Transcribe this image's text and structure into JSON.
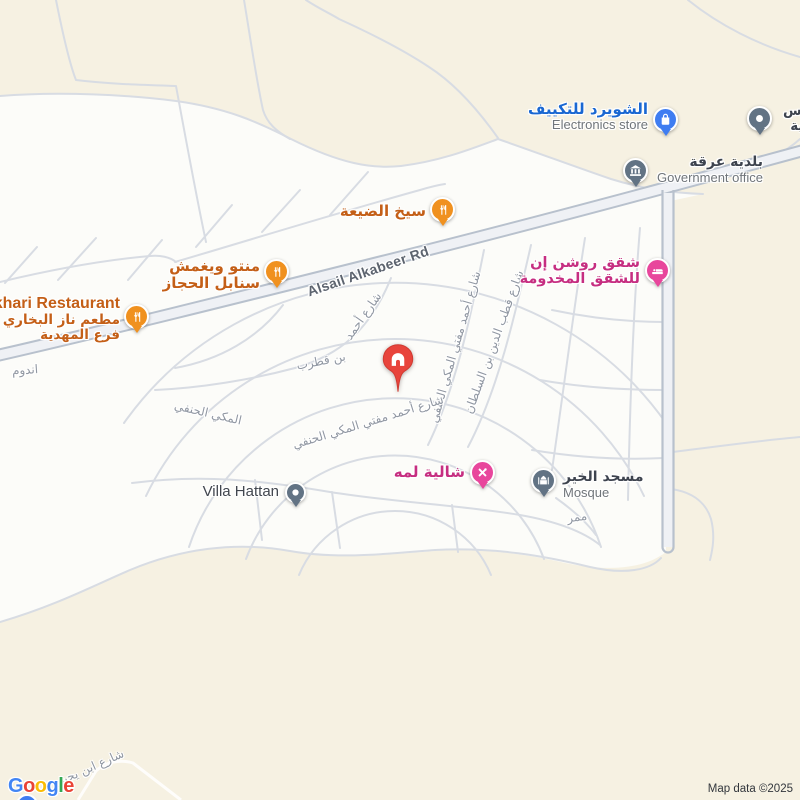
{
  "attribution": "Map data ©2025",
  "logo": {
    "l1": "G",
    "l2": "o",
    "l3": "o",
    "l4": "g",
    "l5": "l",
    "l6": "e"
  },
  "road": {
    "main_label": "Alsail Alkabeer Rd"
  },
  "streets": {
    "qutrub_seg1": "شارع أحمد",
    "qutrub_seg2": "بن قطرب",
    "mufti_vertical": "شارع أحمد مفتي المكي الحنفي",
    "qutb": "شارع قطب الدين بن السلطان",
    "curve_seg1": "المكي الحنفي",
    "curve_seg2": "شارع أحمد مفتي المكي الحنفي",
    "passage": "ممر",
    "left_edge_partial": "اندوم",
    "ibn_yahya": "شارع ابن يحيى",
    "topright_partial_1": "ـدس",
    "topright_partial_2": "ـبية"
  },
  "pois": {
    "electronics": {
      "name": "الشويرد للتكييف",
      "category": "Electronics store",
      "marker_color": "#3f7df1",
      "label_color": "#1967d2"
    },
    "government": {
      "name": "بلدية عرقة",
      "category": "Government office",
      "marker_color": "#627384"
    },
    "seekh": {
      "name": "سيخ الضيعة",
      "marker_color": "#f0911f",
      "label_color": "#c45f17"
    },
    "manto": {
      "name_line1": "منتو ويغمش",
      "name_line2": "سنابل الحجاز",
      "marker_color": "#f0911f"
    },
    "bukhari": {
      "name_partial": "khari Restaurant",
      "name_ar_line1": "مطعم ناز البخاري",
      "name_ar_line2": "فرع المهدية",
      "marker_color": "#f0911f"
    },
    "roshan": {
      "name_line1": "شقق روشن إن",
      "name_line2": "للشقق المخدومة",
      "marker_color": "#e8469c",
      "label_color": "#c62e81"
    },
    "chalet": {
      "name": "شالية لمه",
      "marker_color": "#e8469c"
    },
    "mosque": {
      "name": "مسجد الخير",
      "category": "Mosque",
      "marker_color": "#627384"
    },
    "villa": {
      "name": "Villa Hattan",
      "marker_color": "#627384"
    },
    "property": {
      "marker_color": "#e8443c"
    }
  }
}
